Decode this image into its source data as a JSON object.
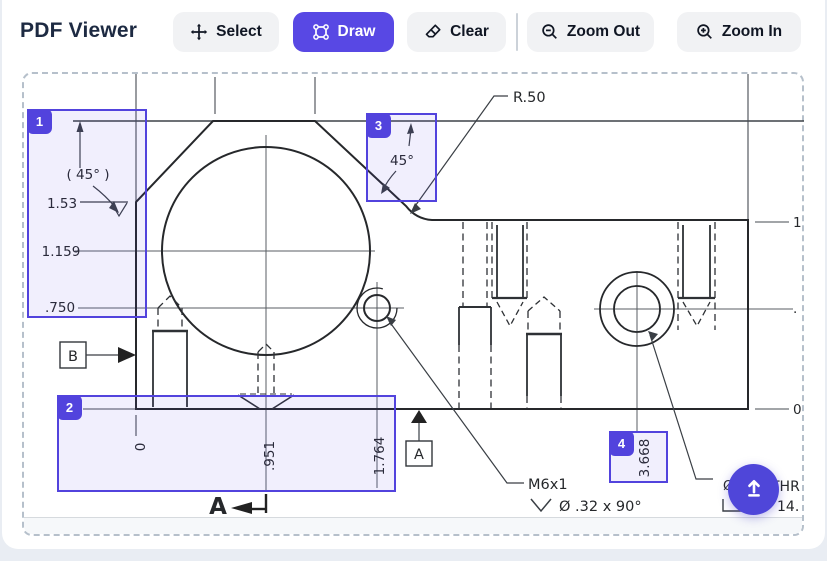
{
  "header": {
    "title": "PDF Viewer"
  },
  "toolbar": {
    "select": "Select",
    "draw": "Draw",
    "clear": "Clear",
    "zoom_out": "Zoom Out",
    "zoom_in": "Zoom In"
  },
  "annotations": {
    "badges": [
      "1",
      "2",
      "3",
      "4"
    ]
  },
  "fab": {
    "icon_name": "upload-arrow-icon"
  },
  "colors": {
    "accent": "#5848e4",
    "annotation_border": "#5243dd",
    "annotation_fill": "rgba(88,72,228,0.085)",
    "toolbar_button_bg": "#f1f2f4",
    "title_color": "#1d2a42",
    "fab_bg": "#4f46d9"
  },
  "drawing": {
    "labels": {
      "r50": "R.50",
      "angle_top": "45°",
      "angle_left": "( 45° )",
      "dim_1_53": "1.53",
      "dim_1_159": "1.159",
      "dim_750": ".750",
      "ord_zero": "0",
      "ord_951": ".951",
      "ord_1764": "1.764",
      "ord_3668": "3.668",
      "right_ord_top": "1",
      "right_ord_mid": ".",
      "right_ord_bottom": "0",
      "datum_b": "B",
      "datum_a": "A",
      "section_a": "A",
      "thread_note": "M6x1",
      "csk_note": "Ø .32 x 90°",
      "frag_dia": "Ø",
      "frag_thru": "THR",
      "frag_cbore": "14."
    }
  }
}
